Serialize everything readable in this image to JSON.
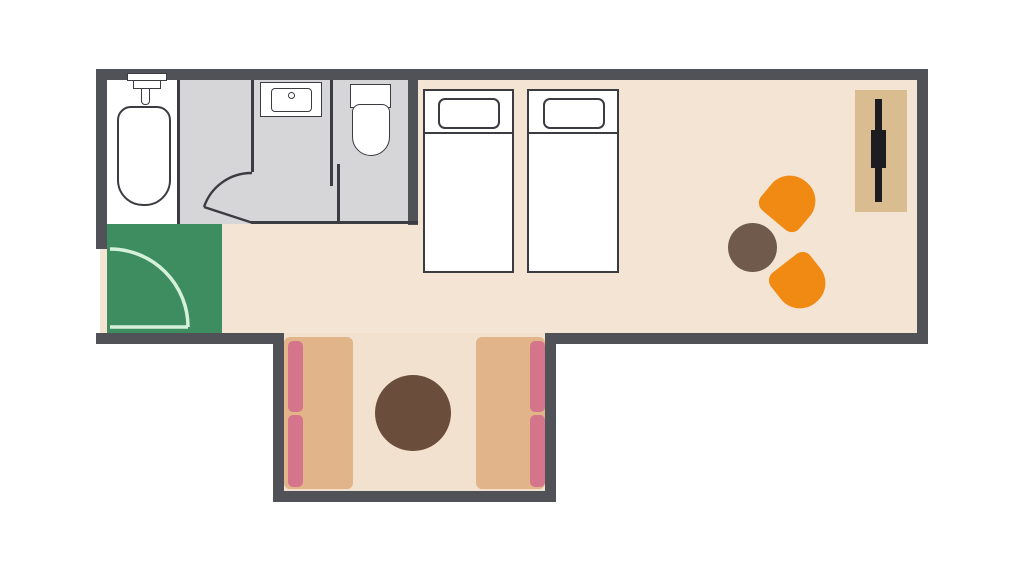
{
  "title": "guest-room-floor-plan",
  "colors": {
    "bg": "#ffffff",
    "wall": "#515257",
    "outline": "#3b3c42",
    "floor_main": "#f4e4d4",
    "floor_alcove": "#f2e1cf",
    "floor_bath": "#d6d6d8",
    "floor_tub": "#ffffff",
    "floor_entry": "#3e8d60",
    "door_arc_entry": "#d6f1da",
    "fixture_fill": "#ffffff",
    "bed_fill": "#ffffff",
    "bench_tan": "#e2b489",
    "cushion_pink": "#d5758b",
    "table_balcony": "#6a4e3b",
    "table_living": "#6f5a4b",
    "chair_orange": "#f08a12",
    "tv_board": "#d9bc90",
    "tv_black": "#1d1d21"
  },
  "rooms": [
    {
      "id": "bathtub-room",
      "floor": "floor_tub"
    },
    {
      "id": "washroom",
      "floor": "floor_bath"
    },
    {
      "id": "toilet-room",
      "floor": "floor_bath"
    },
    {
      "id": "entry-genkan",
      "floor": "floor_entry"
    },
    {
      "id": "bedroom-living",
      "floor": "floor_main"
    },
    {
      "id": "balcony-alcove",
      "floor": "floor_alcove"
    }
  ],
  "icons": [
    "bathtub-icon",
    "shower-faucet-icon",
    "washbasin-icon",
    "toilet-icon",
    "hinged-door-arc-icon",
    "sliding-door-icon",
    "entry-door-arc-icon",
    "single-bed-icon",
    "pillow-icon",
    "tv-cabinet-icon",
    "tv-icon",
    "armchair-icon",
    "round-table-icon",
    "bench-seat-icon",
    "seat-cushion-icon"
  ]
}
